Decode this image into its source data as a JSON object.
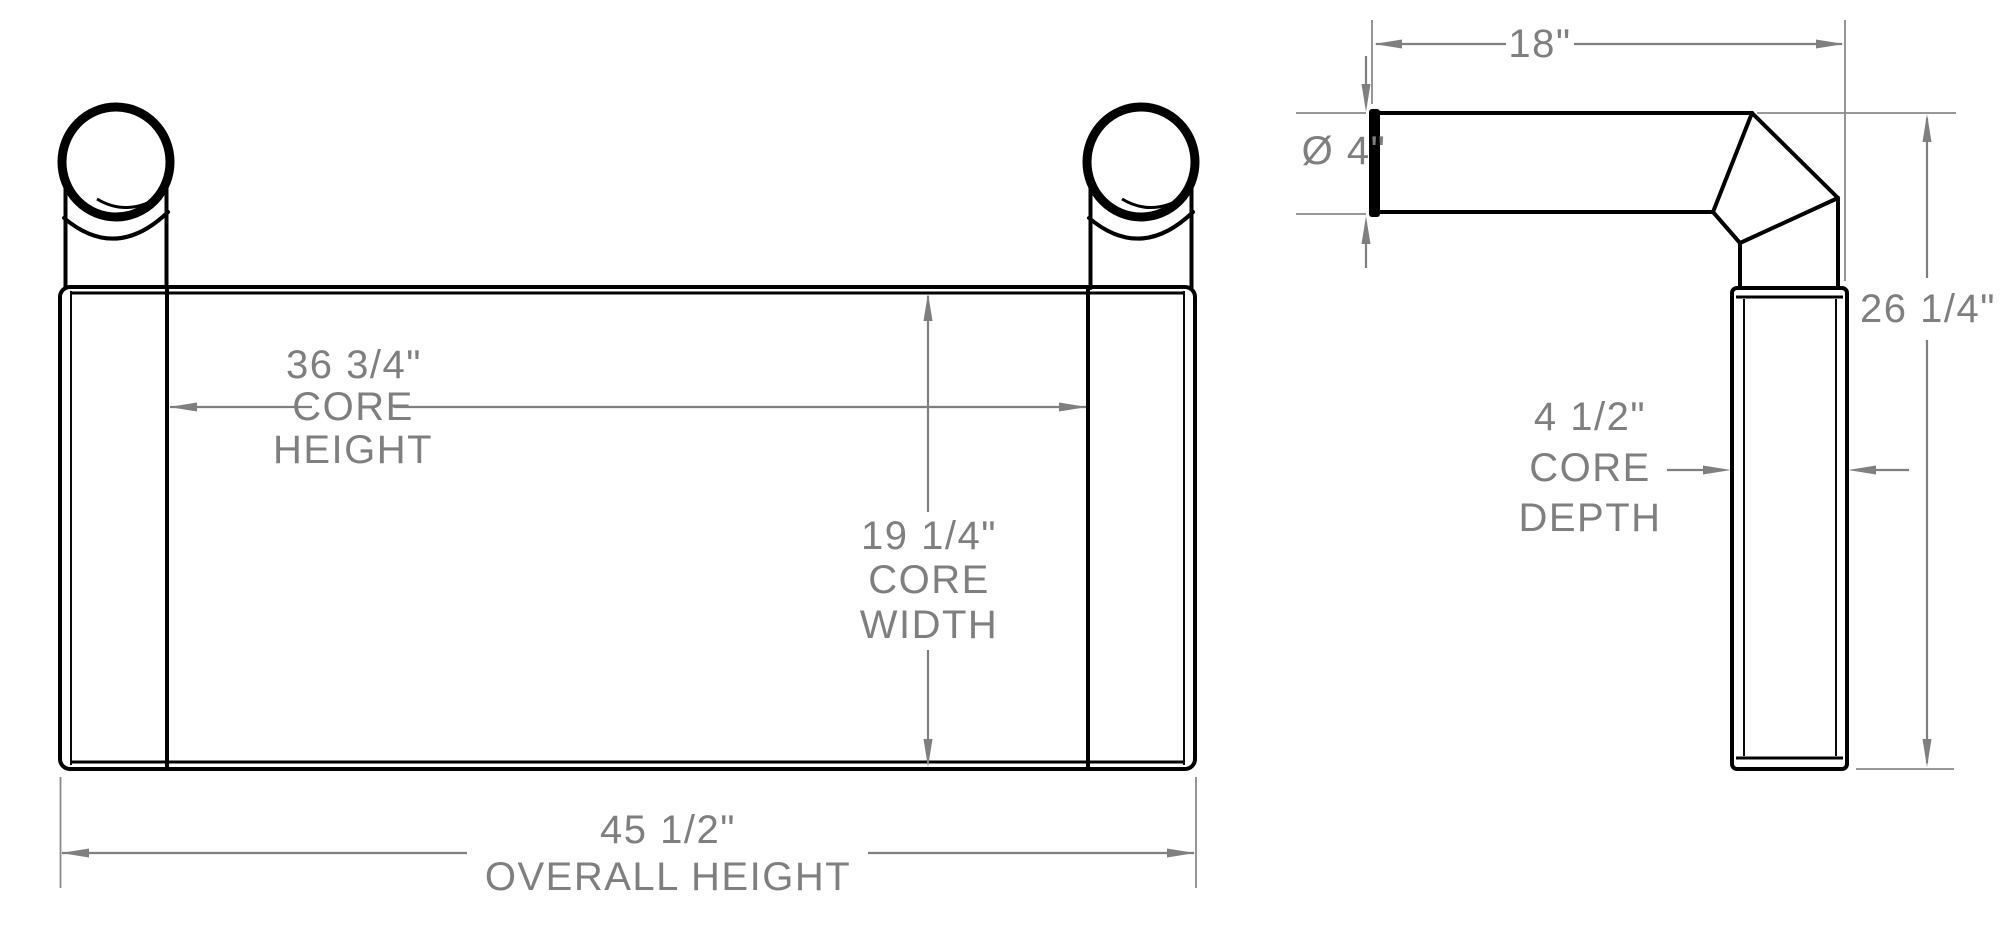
{
  "drawing": {
    "front": {
      "core_height": {
        "value": "36 3/4\"",
        "line2": "CORE",
        "line3": "HEIGHT"
      },
      "core_width": {
        "value": "19 1/4\"",
        "line2": "CORE",
        "line3": "WIDTH"
      },
      "overall_height": {
        "value": "45 1/2\"",
        "label": "OVERALL HEIGHT"
      }
    },
    "side": {
      "pipe_length": {
        "value": "18\""
      },
      "pipe_diameter": {
        "value": "Ø 4\""
      },
      "overall_width": {
        "value": "26 1/4\""
      },
      "core_depth": {
        "value": "4 1/2\"",
        "line2": "CORE",
        "line3": "DEPTH"
      }
    },
    "colors": {
      "outline": "#000000",
      "dimension": "#7f7f7f",
      "background": "#ffffff"
    }
  }
}
